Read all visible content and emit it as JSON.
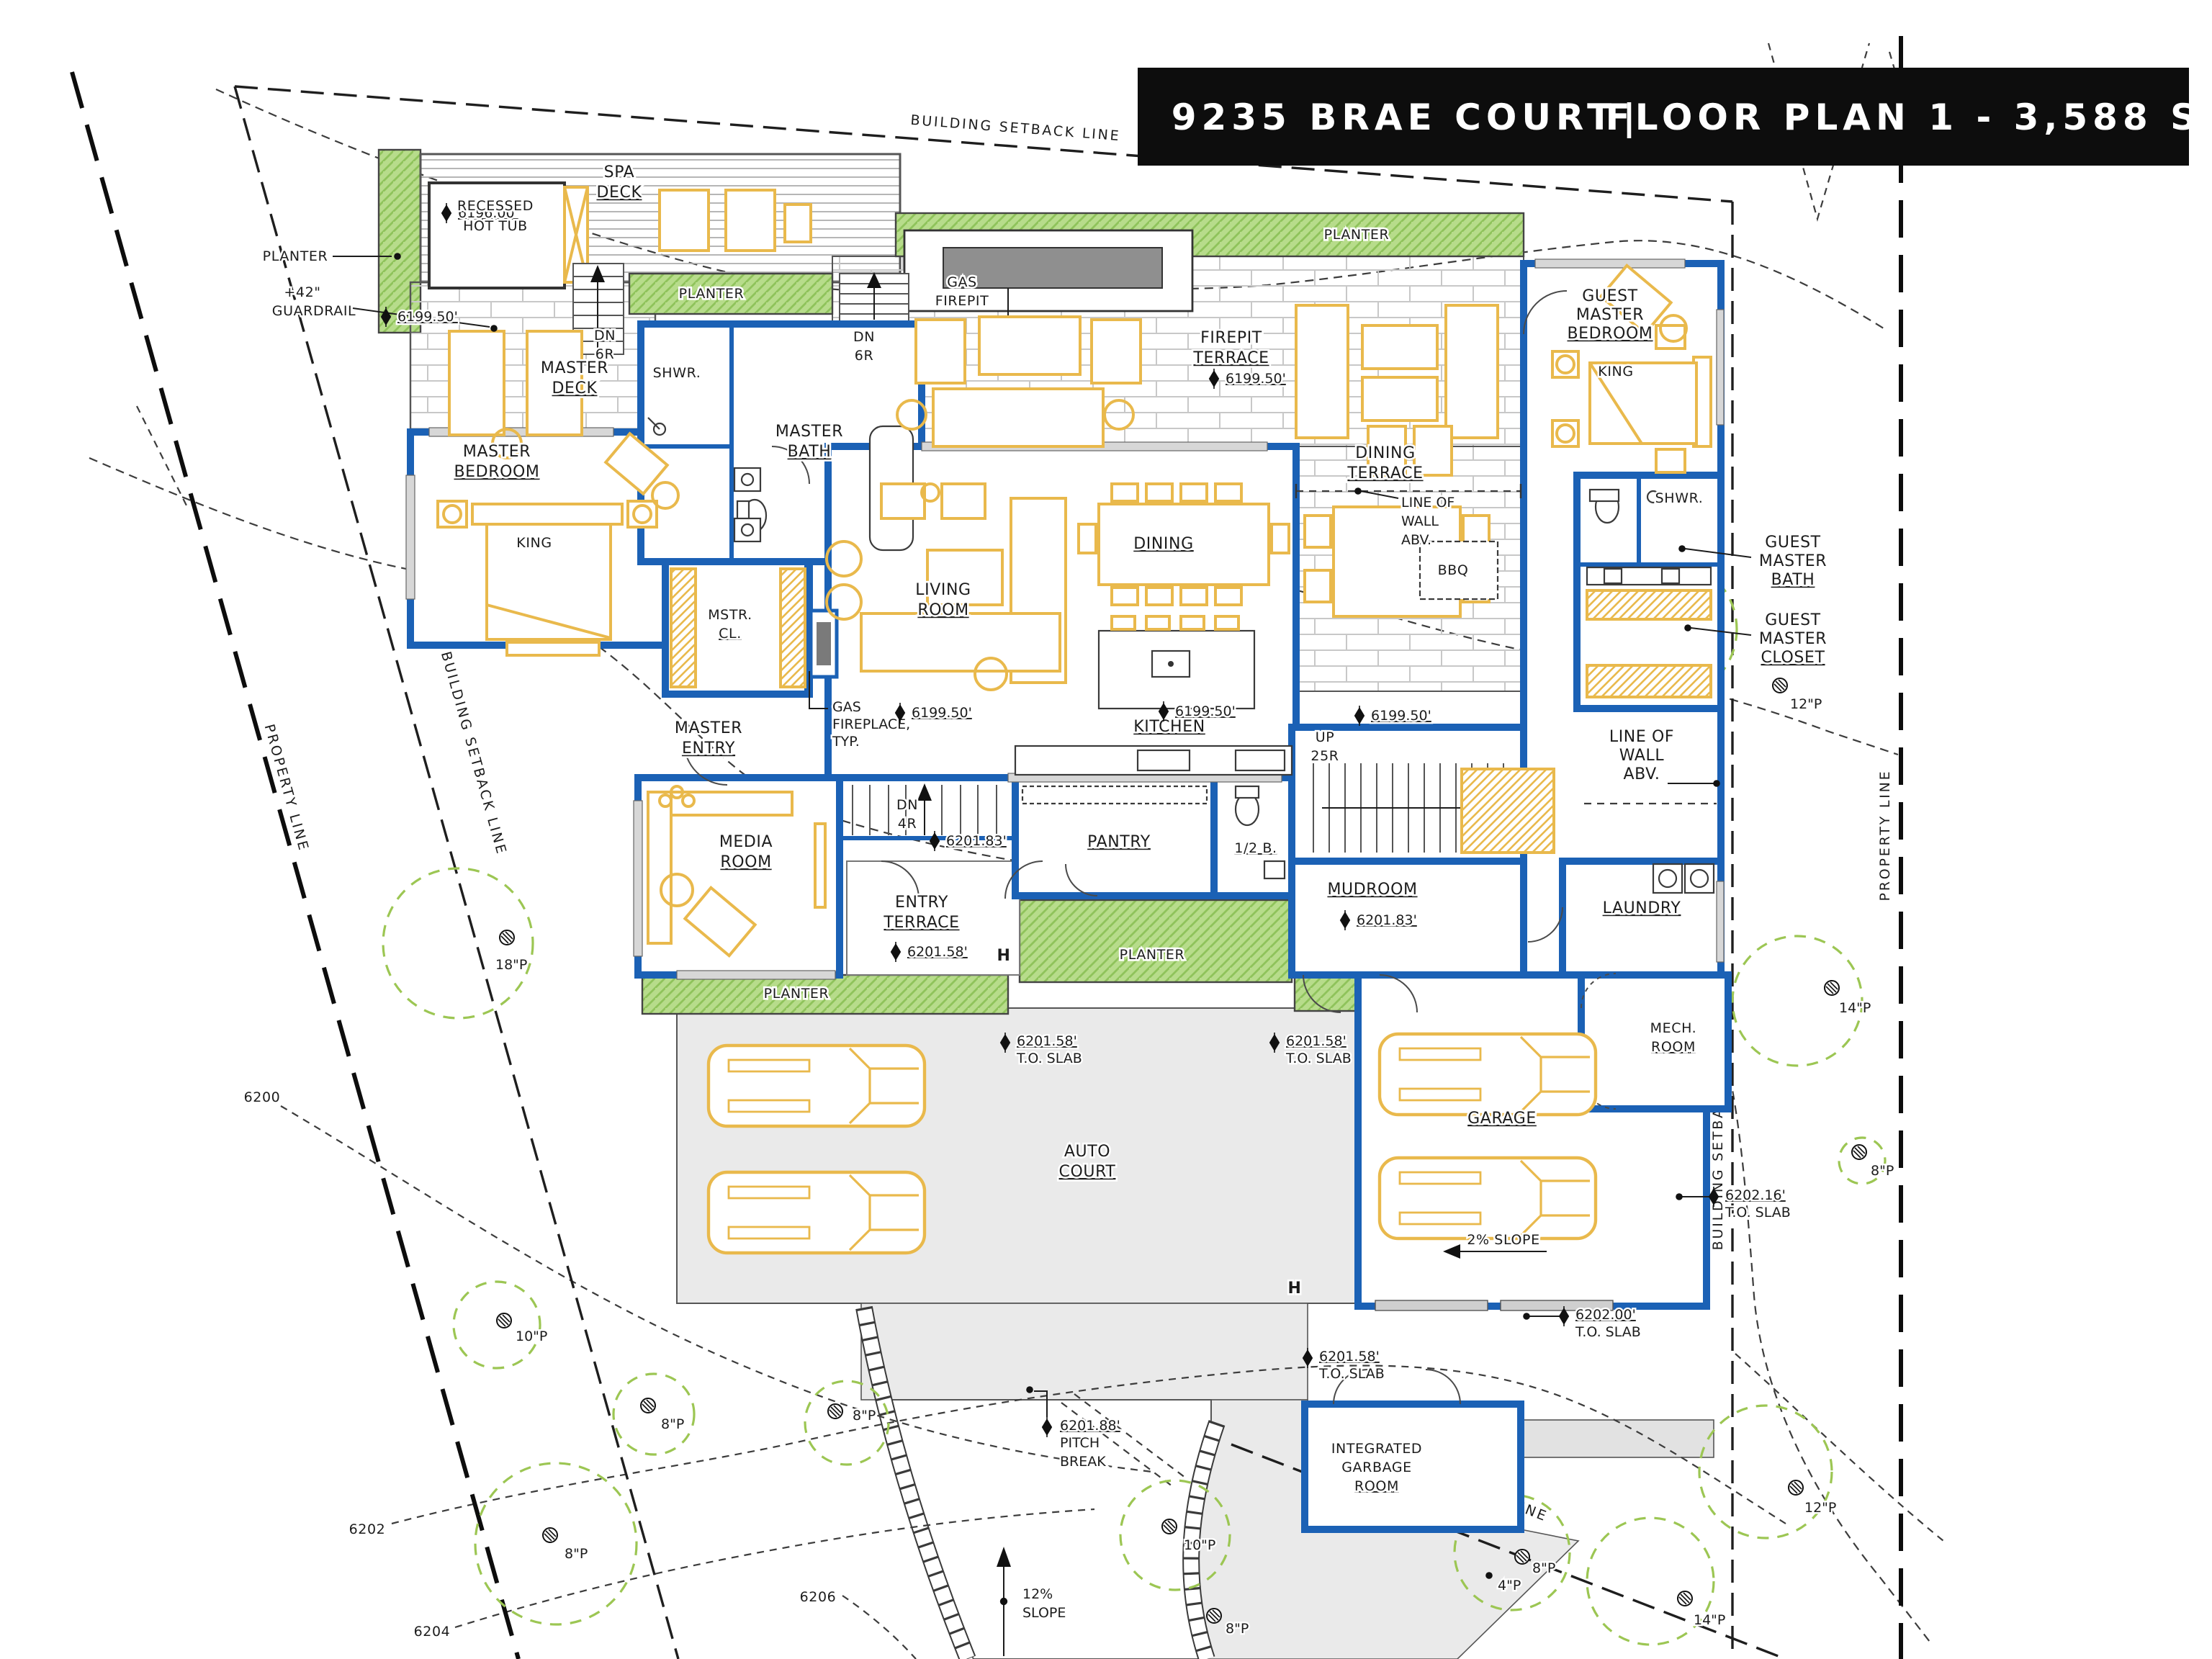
{
  "header": {
    "address": "9235 BRAE COURT",
    "separator": "|",
    "plan": "FLOOR PLAN 1 - 3,588 SF"
  },
  "site": {
    "building_setback_line": "BUILDING SETBACK LINE",
    "property_line": "PROPERTY LINE",
    "contours": {
      "c6200": "6200",
      "c6202": "6202",
      "c6204": "6204",
      "c6206": "6206"
    },
    "slope_12": {
      "l1": "12%",
      "l2": "SLOPE"
    },
    "slope_2": "2% SLOPE",
    "pitch_break": {
      "elev": "6201.88'",
      "l1": "PITCH",
      "l2": "BREAK"
    },
    "to_slab": "T.O. SLAB",
    "hose_bib": "H",
    "trees": {
      "p18": "18\"P",
      "p14": "14\"P",
      "p12": "12\"P",
      "p10": "10\"P",
      "p8": "8\"P",
      "p4": "4\"P"
    }
  },
  "elevations": {
    "spa": "6196.00'",
    "main": "6199.50'",
    "upper": "6201.83'",
    "entry": "6201.58'",
    "garage_upper": "6202.16'",
    "garage_lower": "6202.00'"
  },
  "outdoor": {
    "planter": "PLANTER",
    "spa_deck": {
      "l1": "SPA",
      "l2": "DECK"
    },
    "hot_tub": {
      "l1": "RECESSED",
      "l2": "HOT TUB"
    },
    "guardrail": {
      "l1": "+42\"",
      "l2": "GUARDRAIL"
    },
    "master_deck": {
      "l1": "MASTER",
      "l2": "DECK"
    },
    "gas_firepit": {
      "l1": "GAS",
      "l2": "FIREPIT"
    },
    "firepit_terrace": {
      "l1": "FIREPIT",
      "l2": "TERRACE"
    },
    "dining_terrace": {
      "l1": "DINING",
      "l2": "TERRACE"
    },
    "entry_terrace": {
      "l1": "ENTRY",
      "l2": "TERRACE"
    },
    "auto_court": {
      "l1": "AUTO",
      "l2": "COURT"
    },
    "bbq": "BBQ"
  },
  "rooms": {
    "master_bedroom": {
      "l1": "MASTER",
      "l2": "BEDROOM"
    },
    "king": "KING",
    "master_bath": {
      "l1": "MASTER",
      "l2": "BATH"
    },
    "shower": "SHWR.",
    "master_closet": {
      "l1": "MSTR.",
      "l2": "CL."
    },
    "master_entry": {
      "l1": "MASTER",
      "l2": "ENTRY"
    },
    "living_room": {
      "l1": "LIVING",
      "l2": "ROOM"
    },
    "dining": "DINING",
    "kitchen": "KITCHEN",
    "pantry": "PANTRY",
    "half_bath": "1/2 B.",
    "media_room": {
      "l1": "MEDIA",
      "l2": "ROOM"
    },
    "mudroom": "MUDROOM",
    "laundry": "LAUNDRY",
    "garage": "GARAGE",
    "mech_room": {
      "l1": "MECH.",
      "l2": "ROOM"
    },
    "guest_master_bedroom": {
      "l1": "GUEST",
      "l2": "MASTER",
      "l3": "BEDROOM"
    },
    "guest_master_bath": {
      "l1": "GUEST",
      "l2": "MASTER",
      "l3": "BATH"
    },
    "guest_master_closet": {
      "l1": "GUEST",
      "l2": "MASTER",
      "l3": "CLOSET"
    },
    "garbage_room": {
      "l1": "INTEGRATED",
      "l2": "GARBAGE",
      "l3": "ROOM"
    }
  },
  "notes": {
    "gas_fireplace": {
      "l1": "GAS",
      "l2": "FIREPLACE,",
      "l3": "TYP."
    },
    "line_of_wall": {
      "l1": "LINE OF",
      "l2": "WALL",
      "l3": "ABV."
    },
    "up_stairs": {
      "l1": "UP",
      "l2": "25R"
    },
    "dn6": {
      "l1": "DN",
      "l2": "6R"
    },
    "dn4": {
      "l1": "DN",
      "l2": "4R"
    }
  },
  "colors": {
    "wall": "#1b61b5",
    "furniture": "#e9b94c",
    "planter": "#b7dc8b",
    "paving": "#eaeaea",
    "tree": "#9cc653",
    "title_bar": "#0d0d0d"
  }
}
